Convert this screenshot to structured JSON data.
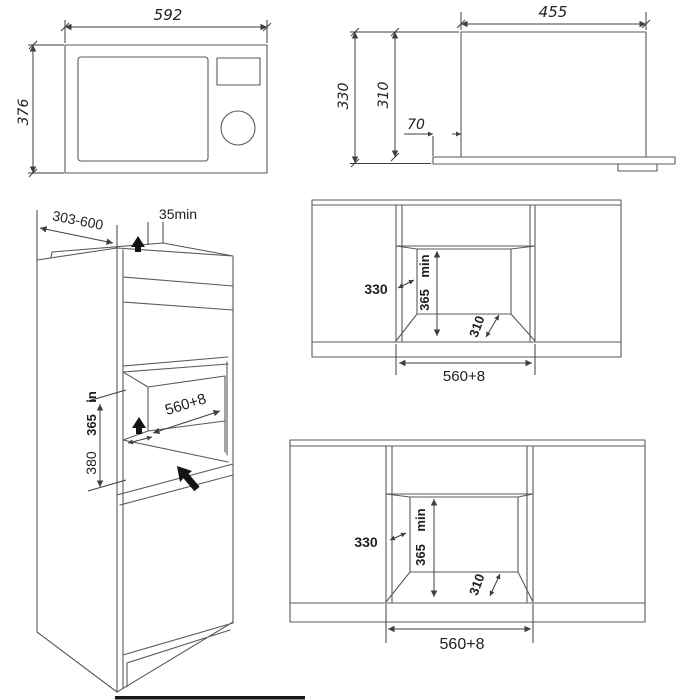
{
  "colors": {
    "background": "#ffffff",
    "object_line": "#5a5a5a",
    "dimension_line": "#3f3f3f",
    "text": "#1f1f1f",
    "solid_arrow": "#141414"
  },
  "front_view": {
    "width": "592",
    "height": "376"
  },
  "side_view": {
    "depth": "455",
    "overall_height": "330",
    "body_height": "310",
    "fascia_offset": "70"
  },
  "cabinet_view": {
    "cabinet_depth_range": "303-600",
    "top_clearance": "35min",
    "niche_width": "560+8",
    "niche_height_a": "380",
    "niche_height_b": "365",
    "niche_height_unit": "in"
  },
  "niche_upper": {
    "side_depth": "330",
    "min_height_value": "365",
    "min_height_unit": "min",
    "floor_depth": "310",
    "opening_width": "560+8"
  },
  "niche_lower": {
    "side_depth": "330",
    "min_height_value": "365",
    "min_height_unit": "min",
    "floor_depth": "310",
    "opening_width": "560+8"
  }
}
